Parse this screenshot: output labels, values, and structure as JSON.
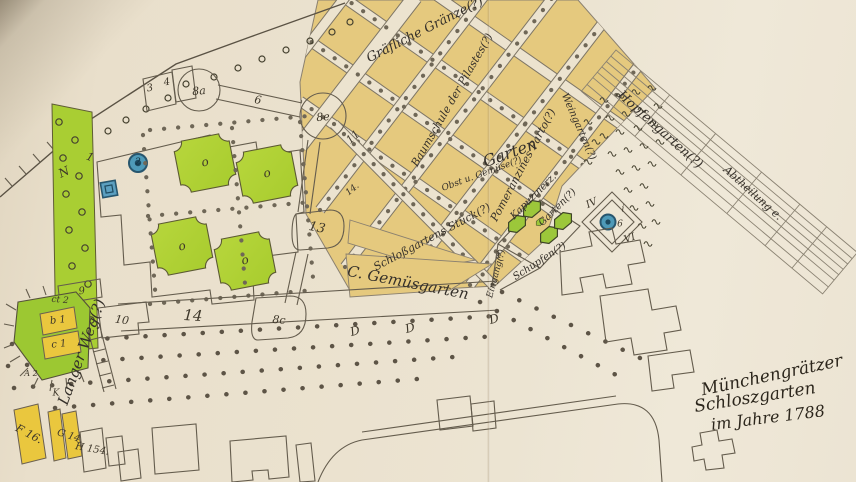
{
  "map_title": {
    "line1": "Münchengrätzer",
    "line2": "Schloszgarten",
    "line3": "im Jahre 1788"
  },
  "annotations": {
    "top_boundary": "Gräfliche Gränze(?)",
    "nursery": "Baumschule der Pilastes(?)",
    "pomeranzen": "Pomeranzines Parto(?)",
    "garten": "Garten",
    "obst": "Obst u. Gemüse(?)",
    "kapuziner1": "Kapuzinerz.",
    "kapuziner2": "Garten(?)",
    "gemuese": "C. Gemüsgarten",
    "stueck": "Schloßgartens Stück(?)",
    "abtheilung": "Abtheilung e.",
    "hopfen": "Hopfengarten(?)",
    "wein": "Weingarten(?)",
    "eingang": "Eingang(?)",
    "schupfen": "Schupfen(?)",
    "langer_weg": "Langer Weg(?)",
    "alley14": "14."
  },
  "labels": {
    "n": "N",
    "one": "1",
    "two": "2",
    "three": "3",
    "four": "4",
    "six": "6",
    "eight_a": "8a",
    "eight_e": "8e",
    "eight_c": "8c",
    "nine": "9",
    "ten": "10",
    "eleven": "11",
    "thirteen": "13",
    "fourteen": "14",
    "ct2": "ct 2",
    "b1": "b 1",
    "c1": "c 1",
    "a2": "A 2",
    "k": "K",
    "f16": "F 16.",
    "g14": "G 14.",
    "h154": "H 154.",
    "d": "D",
    "iv": "IV",
    "vi": "VI",
    "i_small": "i",
    "six_small": "6",
    "stueck_i": "I",
    "o": "o"
  },
  "colors": {
    "paper": "#ebe2cf",
    "orchard_tan": "#e5c97e",
    "parterre_green": "#b2d338",
    "allee_green": "#a9ce33",
    "bed_green": "#9cc73a",
    "building_yellow": "#eac73e",
    "fountain_blue": "#4e9ab8",
    "ink": "#5a5244"
  }
}
